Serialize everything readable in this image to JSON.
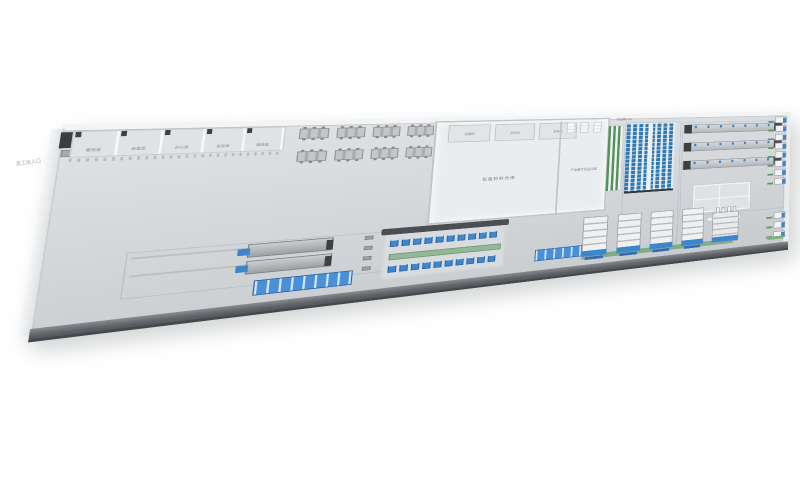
{
  "scene": {
    "description": "3D isometric factory floor layout rendering",
    "background": "#ffffff"
  },
  "labels": {
    "entrance_left": "员工出入口",
    "office_rooms": [
      "更衣室",
      "休息室",
      "办公室",
      "会议室",
      "接待室"
    ],
    "rest_area": "休息区",
    "utility_rooms": [
      "空调间",
      "空压间",
      "配电间"
    ],
    "main_hall": "包装材料仓库",
    "showroom": "产品展厅及会议室",
    "finished_goods": "成品库入口"
  },
  "colors": {
    "floor": "#d3d6d9",
    "building_floor": "#eaedef",
    "front_wall": "#5e6266",
    "accent_blue": "#3d86c9",
    "rack_blue": "#2e7ab6",
    "green": "#5a9a5f",
    "label_gray": "#70757a"
  },
  "equipment": {
    "desk_clusters": 8,
    "showroom_racks": 3,
    "production_lines": 3,
    "wall_machines_upper": 8,
    "wall_machines_lower": 3,
    "worktables": 5,
    "gantry_stations_per_row": 10,
    "coating_units": 4,
    "conveyor_posts": 4
  }
}
